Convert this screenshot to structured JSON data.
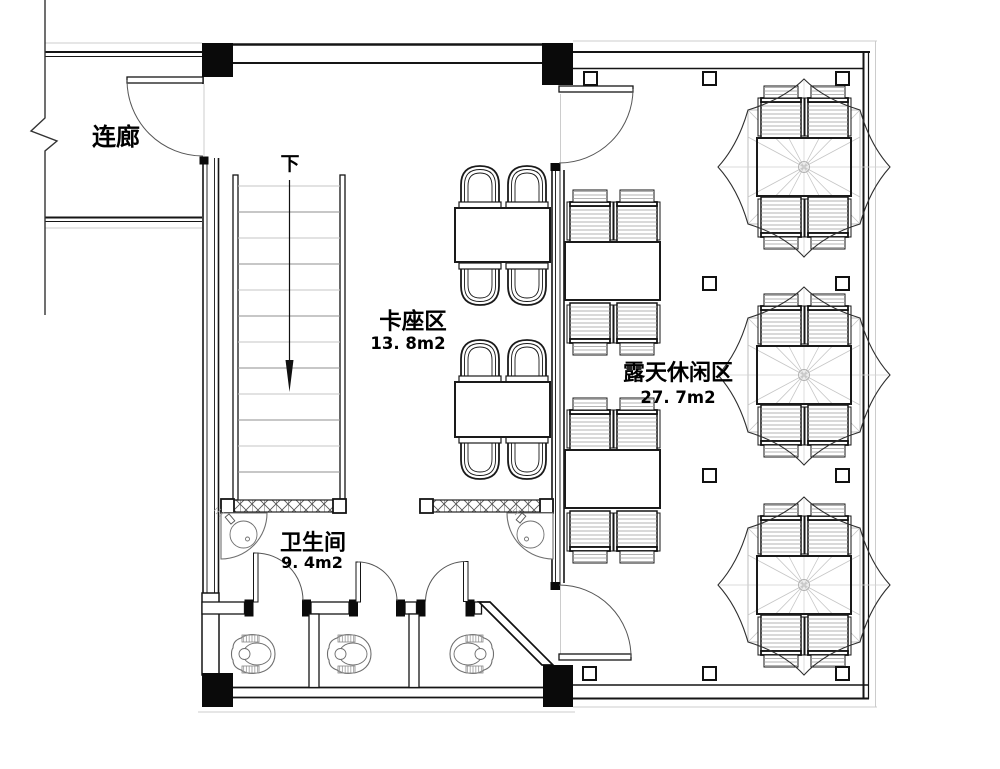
{
  "plan": {
    "type": "architectural-floor-plan",
    "labels": {
      "corridor": "连廊",
      "stair_down": "下",
      "booth_name": "卡座区",
      "booth_area": "13. 8m2",
      "terrace_name": "露天休闲区",
      "terrace_area": "27. 7m2",
      "restroom_name": "卫生间",
      "restroom_area": "9. 4m2"
    },
    "colors": {
      "wall_line": "#151515",
      "medium_line": "#8f8f8f",
      "light_line": "#cccccc",
      "background": "#ffffff"
    }
  }
}
